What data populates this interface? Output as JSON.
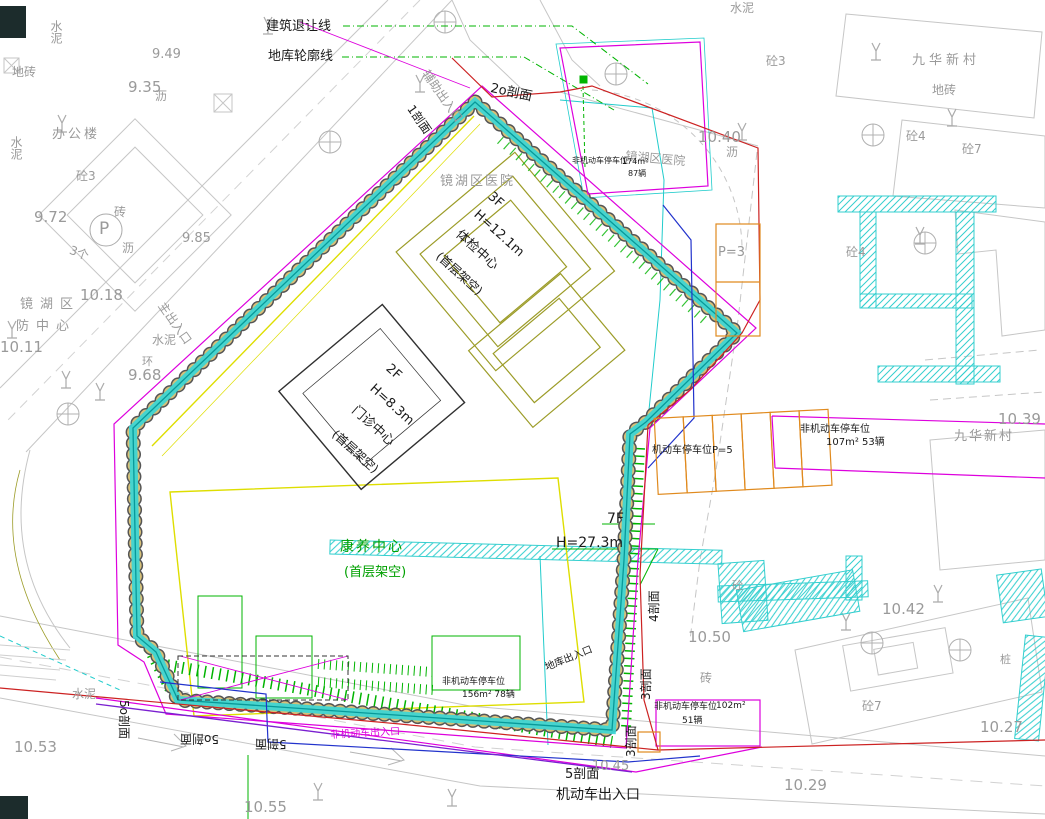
{
  "drawing": {
    "type": "construction site plan (CAD)",
    "key_structures": [
      {
        "name": "体检中心",
        "floors": "3F",
        "height": "H=12.1m",
        "note": "(首层架空)"
      },
      {
        "name": "门诊中心",
        "floors": "2F",
        "height": "H=8.3m",
        "note": "(首层架空)"
      },
      {
        "name": "康养中心",
        "floors": "7F",
        "height": "H=27.3m",
        "note": "(首层架空)"
      }
    ],
    "colors": {
      "support_wall": "#3bd6d6",
      "pile": "#d8c078",
      "hatch": "#35cfcf",
      "landscape": "#00b400",
      "boundary_red": "#cc2222",
      "underground": "#dd00dd",
      "utility_blue": "#2233cc",
      "utility_purple": "#7a1fd0",
      "podium_yellow": "#dede00",
      "building_olive": "#9c9c28",
      "parking_orange": "#e08a1e",
      "basemap_gray": "#c2c2c2",
      "text_gray": "#9a9a9a"
    }
  },
  "labels": [
    {
      "n": "building-setback-line-label",
      "t": "建筑退让线",
      "x": 266,
      "y": 20,
      "s": 13,
      "c": "#1a1a1a"
    },
    {
      "n": "basement-outline-label",
      "t": "地库轮廓线",
      "x": 268,
      "y": 50,
      "s": 13,
      "c": "#1a1a1a"
    },
    {
      "n": "auxiliary-entrance-label",
      "t": "辅助出入口",
      "x": 430,
      "y": 68,
      "s": 12,
      "c": "#9a9a9a",
      "r": 55
    },
    {
      "n": "section-1-label",
      "t": "1剖面",
      "x": 415,
      "y": 103,
      "s": 12,
      "c": "#1a1a1a",
      "r": 55
    },
    {
      "n": "section-2-label",
      "t": "2o剖面",
      "x": 492,
      "y": 82,
      "s": 13,
      "c": "#1a1a1a",
      "r": 12
    },
    {
      "n": "hospital-label",
      "t": "镜湖区医院",
      "x": 440,
      "y": 175,
      "s": 13,
      "c": "#9a9a9a",
      "ls": 2
    },
    {
      "n": "hospital-label",
      "t": "镜湖区医院",
      "x": 626,
      "y": 150,
      "s": 12,
      "c": "#9a9a9a",
      "r": 5
    },
    {
      "n": "building1-floors",
      "t": "3F",
      "x": 494,
      "y": 190,
      "s": 13,
      "c": "#1a1a1a",
      "r": 42
    },
    {
      "n": "building1-height",
      "t": "H=12.1m",
      "x": 480,
      "y": 208,
      "s": 13,
      "c": "#1a1a1a",
      "r": 42
    },
    {
      "n": "building1-name",
      "t": "体检中心",
      "x": 462,
      "y": 228,
      "s": 13,
      "c": "#1a1a1a",
      "r": 42
    },
    {
      "n": "building1-note",
      "t": "(首层架空)",
      "x": 442,
      "y": 250,
      "s": 12,
      "c": "#1a1a1a",
      "r": 42
    },
    {
      "n": "building2-floors",
      "t": "2F",
      "x": 392,
      "y": 362,
      "s": 13,
      "c": "#1a1a1a",
      "r": 42
    },
    {
      "n": "building2-height",
      "t": "H=8.3m",
      "x": 376,
      "y": 382,
      "s": 13,
      "c": "#1a1a1a",
      "r": 42
    },
    {
      "n": "building2-name",
      "t": "门诊中心",
      "x": 358,
      "y": 404,
      "s": 13,
      "c": "#1a1a1a",
      "r": 42
    },
    {
      "n": "building2-note",
      "t": "(首层架空)",
      "x": 338,
      "y": 428,
      "s": 12,
      "c": "#1a1a1a",
      "r": 42
    },
    {
      "n": "building3-name",
      "t": "康养中心",
      "x": 340,
      "y": 540,
      "s": 14,
      "c": "#00a000",
      "ls": 2
    },
    {
      "n": "building3-note",
      "t": "(首层架空)",
      "x": 344,
      "y": 566,
      "s": 13,
      "c": "#00a000"
    },
    {
      "n": "building3-floors",
      "t": "7F",
      "x": 607,
      "y": 512,
      "s": 14,
      "c": "#1a1a1a"
    },
    {
      "n": "building3-height",
      "t": "H=27.3m",
      "x": 556,
      "y": 536,
      "s": 14,
      "c": "#1a1a1a"
    },
    {
      "n": "main-entrance-label",
      "t": "主出入口",
      "x": 166,
      "y": 300,
      "s": 12,
      "c": "#9a9a9a",
      "r": 55
    },
    {
      "n": "vehicle-entrance-label",
      "t": "机动车出入口",
      "x": 556,
      "y": 788,
      "s": 14,
      "c": "#1a1a1a"
    },
    {
      "n": "non-motor-entrance-label",
      "t": "非机动车出入口",
      "x": 330,
      "y": 731,
      "s": 10,
      "c": "#dd00dd",
      "r": -3
    },
    {
      "n": "garage-entrance-label",
      "t": "地库出入口",
      "x": 544,
      "y": 664,
      "s": 10,
      "c": "#1a1a1a",
      "r": -22
    },
    {
      "n": "section-5o-label",
      "t": "5o剖面",
      "x": 130,
      "y": 700,
      "s": 12,
      "c": "#1a1a1a",
      "r": 90
    },
    {
      "n": "section-5o-label",
      "t": "5o剖面",
      "x": 180,
      "y": 733,
      "s": 12,
      "c": "#1a1a1a",
      "r": 180
    },
    {
      "n": "section-5-label",
      "t": "5剖面",
      "x": 255,
      "y": 738,
      "s": 12,
      "c": "#1a1a1a",
      "r": 180
    },
    {
      "n": "section-5-label",
      "t": "5剖面",
      "x": 565,
      "y": 768,
      "s": 13,
      "c": "#1a1a1a"
    },
    {
      "n": "section-3-label",
      "t": "3剖面",
      "x": 625,
      "y": 757,
      "s": 12,
      "c": "#1a1a1a",
      "r": -90
    },
    {
      "n": "section-3-label",
      "t": "3剖面",
      "x": 640,
      "y": 700,
      "s": 12,
      "c": "#1a1a1a",
      "r": -90
    },
    {
      "n": "section-4-label",
      "t": "4剖面",
      "x": 648,
      "y": 622,
      "s": 12,
      "c": "#1a1a1a",
      "r": -90
    },
    {
      "n": "spot-elevation",
      "t": "10.40",
      "x": 698,
      "y": 130,
      "s": 15,
      "c": "#9a9a9a"
    },
    {
      "n": "spot-elevation",
      "t": "10.39",
      "x": 998,
      "y": 412,
      "s": 15,
      "c": "#9a9a9a"
    },
    {
      "n": "spot-elevation",
      "t": "10.42",
      "x": 882,
      "y": 602,
      "s": 15,
      "c": "#9a9a9a"
    },
    {
      "n": "spot-elevation",
      "t": "10.50",
      "x": 688,
      "y": 630,
      "s": 15,
      "c": "#9a9a9a"
    },
    {
      "n": "spot-elevation",
      "t": "10.27",
      "x": 980,
      "y": 720,
      "s": 15,
      "c": "#9a9a9a"
    },
    {
      "n": "spot-elevation",
      "t": "10.29",
      "x": 784,
      "y": 778,
      "s": 15,
      "c": "#9a9a9a"
    },
    {
      "n": "spot-elevation",
      "t": "10.53",
      "x": 14,
      "y": 740,
      "s": 15,
      "c": "#9a9a9a"
    },
    {
      "n": "spot-elevation",
      "t": "10.55",
      "x": 244,
      "y": 800,
      "s": 15,
      "c": "#9a9a9a"
    },
    {
      "n": "spot-elevation",
      "t": "10.45",
      "x": 592,
      "y": 760,
      "s": 13,
      "c": "#9a9a9a"
    },
    {
      "n": "spot-elevation",
      "t": "10.18",
      "x": 80,
      "y": 288,
      "s": 15,
      "c": "#9a9a9a"
    },
    {
      "n": "spot-elevation",
      "t": "10.11",
      "x": 0,
      "y": 340,
      "s": 15,
      "c": "#9a9a9a"
    },
    {
      "n": "spot-elevation",
      "t": "9.68",
      "x": 128,
      "y": 368,
      "s": 15,
      "c": "#9a9a9a"
    },
    {
      "n": "spot-elevation",
      "t": "9.72",
      "x": 34,
      "y": 210,
      "s": 15,
      "c": "#9a9a9a"
    },
    {
      "n": "spot-elevation",
      "t": "9.85",
      "x": 182,
      "y": 232,
      "s": 13,
      "c": "#9a9a9a"
    },
    {
      "n": "spot-elevation",
      "t": "9.35",
      "x": 128,
      "y": 80,
      "s": 15,
      "c": "#9a9a9a"
    },
    {
      "n": "spot-elevation",
      "t": "9.49",
      "x": 152,
      "y": 48,
      "s": 13,
      "c": "#9a9a9a"
    },
    {
      "n": "office-building-label",
      "t": "办公楼",
      "x": 52,
      "y": 128,
      "s": 13,
      "c": "#9a9a9a",
      "ls": 3
    },
    {
      "n": "material-label",
      "t": "水泥",
      "x": 50,
      "y": 20,
      "s": 12,
      "c": "#9a9a9a",
      "v": true
    },
    {
      "n": "material-label",
      "t": "水泥",
      "x": 10,
      "y": 136,
      "s": 12,
      "c": "#9a9a9a",
      "v": true
    },
    {
      "n": "material-label",
      "t": "水泥",
      "x": 152,
      "y": 334,
      "s": 12,
      "c": "#9a9a9a"
    },
    {
      "n": "material-label",
      "t": "水泥",
      "x": 72,
      "y": 688,
      "s": 12,
      "c": "#9a9a9a"
    },
    {
      "n": "material-label",
      "t": "水泥",
      "x": 730,
      "y": 2,
      "s": 12,
      "c": "#9a9a9a"
    },
    {
      "n": "material-label",
      "t": "沥",
      "x": 155,
      "y": 90,
      "s": 12,
      "c": "#9a9a9a"
    },
    {
      "n": "material-label",
      "t": "沥",
      "x": 122,
      "y": 242,
      "s": 12,
      "c": "#9a9a9a"
    },
    {
      "n": "material-label",
      "t": "沥",
      "x": 726,
      "y": 146,
      "s": 12,
      "c": "#9a9a9a"
    },
    {
      "n": "material-label",
      "t": "砖",
      "x": 114,
      "y": 206,
      "s": 12,
      "c": "#9a9a9a"
    },
    {
      "n": "material-label",
      "t": "砖",
      "x": 700,
      "y": 672,
      "s": 12,
      "c": "#9a9a9a"
    },
    {
      "n": "material-label",
      "t": "地砖",
      "x": 12,
      "y": 66,
      "s": 12,
      "c": "#9a9a9a"
    },
    {
      "n": "material-label",
      "t": "地砖",
      "x": 932,
      "y": 84,
      "s": 12,
      "c": "#9a9a9a"
    },
    {
      "n": "material-label",
      "t": "桩",
      "x": 1000,
      "y": 654,
      "s": 11,
      "c": "#9a9a9a"
    },
    {
      "n": "material-label",
      "t": "环",
      "x": 142,
      "y": 356,
      "s": 11,
      "c": "#9a9a9a"
    },
    {
      "n": "count-label",
      "t": "3个",
      "x": 72,
      "y": 244,
      "s": 12,
      "c": "#9a9a9a",
      "r": 20
    },
    {
      "n": "parking-p-label",
      "t": "P",
      "x": 99,
      "y": 221,
      "s": 17,
      "c": "#9a9a9a"
    },
    {
      "n": "district-label",
      "t": "镜湖区",
      "x": 20,
      "y": 298,
      "s": 13,
      "c": "#9a9a9a",
      "ls": 7
    },
    {
      "n": "district-label",
      "t": "防中心",
      "x": 16,
      "y": 320,
      "s": 13,
      "c": "#9a9a9a",
      "ls": 7
    },
    {
      "n": "village-label",
      "t": "九华新村",
      "x": 912,
      "y": 54,
      "s": 13,
      "c": "#9a9a9a",
      "ls": 4
    },
    {
      "n": "village-label",
      "t": "九华新村",
      "x": 954,
      "y": 430,
      "s": 13,
      "c": "#9a9a9a",
      "ls": 2
    },
    {
      "n": "material-label",
      "t": "砼3",
      "x": 766,
      "y": 55,
      "s": 12,
      "c": "#9a9a9a"
    },
    {
      "n": "material-label",
      "t": "砼3",
      "x": 76,
      "y": 170,
      "s": 12,
      "c": "#9a9a9a"
    },
    {
      "n": "material-label",
      "t": "砼4",
      "x": 906,
      "y": 130,
      "s": 12,
      "c": "#9a9a9a"
    },
    {
      "n": "material-label",
      "t": "砼4",
      "x": 846,
      "y": 246,
      "s": 12,
      "c": "#9a9a9a"
    },
    {
      "n": "material-label",
      "t": "砼7",
      "x": 962,
      "y": 143,
      "s": 12,
      "c": "#9a9a9a"
    },
    {
      "n": "material-label",
      "t": "砼7",
      "x": 862,
      "y": 700,
      "s": 12,
      "c": "#9a9a9a"
    },
    {
      "n": "material-label",
      "t": "砼",
      "x": 732,
      "y": 580,
      "s": 11,
      "c": "#9a9a9a"
    },
    {
      "n": "parking-count-label",
      "t": "P=3",
      "x": 718,
      "y": 246,
      "s": 13,
      "c": "#9a9a9a"
    },
    {
      "n": "parking-label",
      "t": "机动车停车位P=5",
      "x": 652,
      "y": 446,
      "s": 10,
      "c": "#1a1a1a"
    },
    {
      "n": "parking-label",
      "t": "非机动车停车位",
      "x": 800,
      "y": 425,
      "s": 10,
      "c": "#1a1a1a"
    },
    {
      "n": "parking-value",
      "t": "107m²  53辆",
      "x": 826,
      "y": 438,
      "s": 10,
      "c": "#1a1a1a"
    },
    {
      "n": "parking-label",
      "t": "非机动车停车位",
      "x": 572,
      "y": 157,
      "s": 8,
      "c": "#1a1a1a"
    },
    {
      "n": "parking-value",
      "t": "174m²",
      "x": 622,
      "y": 158,
      "s": 8,
      "c": "#1a1a1a"
    },
    {
      "n": "parking-value",
      "t": "87辆",
      "x": 628,
      "y": 170,
      "s": 8,
      "c": "#1a1a1a"
    },
    {
      "n": "parking-label",
      "t": "非机动车停车位",
      "x": 442,
      "y": 678,
      "s": 9,
      "c": "#1a1a1a"
    },
    {
      "n": "parking-value",
      "t": "156m²  78辆",
      "x": 462,
      "y": 691,
      "s": 9,
      "c": "#1a1a1a"
    },
    {
      "n": "parking-label",
      "t": "非机动车停车位",
      "x": 654,
      "y": 703,
      "s": 9,
      "c": "#1a1a1a"
    },
    {
      "n": "parking-value",
      "t": "102m²",
      "x": 716,
      "y": 702,
      "s": 9,
      "c": "#1a1a1a"
    },
    {
      "n": "parking-value",
      "t": "51辆",
      "x": 682,
      "y": 717,
      "s": 9,
      "c": "#1a1a1a"
    }
  ]
}
